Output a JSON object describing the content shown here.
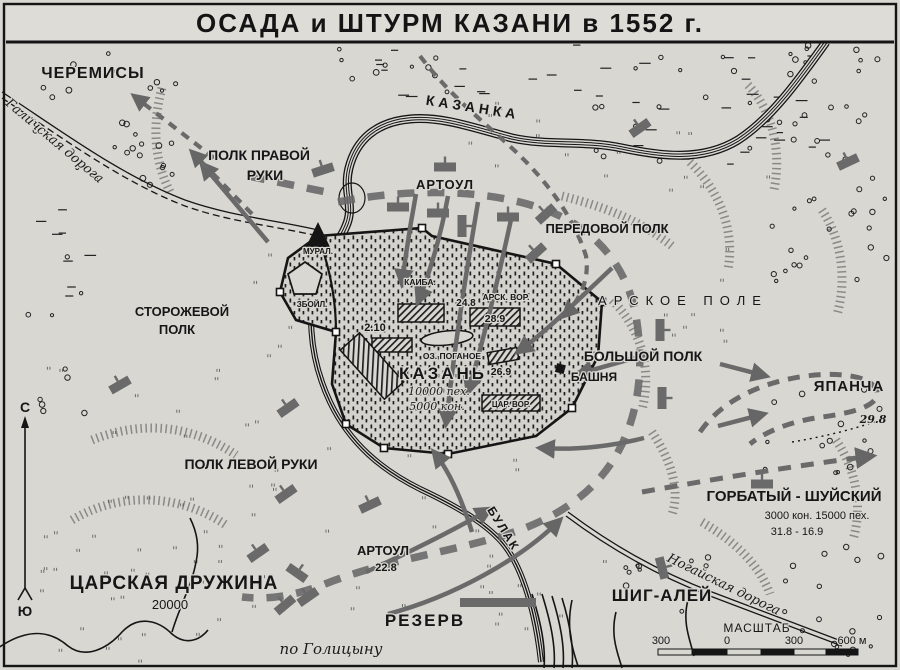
{
  "title": "ОСАДА  и  ШТУРМ  КАЗАНИ  в 1552 г.",
  "colors": {
    "paper": "#d8d7d2",
    "ink": "#151515",
    "military_gray": "#6a6a6a"
  },
  "compass": {
    "north": "С",
    "south": "Ю"
  },
  "rivers": {
    "kazanka": "КАЗАНКА",
    "bulak": "БУЛАК"
  },
  "roads": {
    "galich": "Галичская дорога",
    "nogai": "Ногайская дорога"
  },
  "places": {
    "cheremisy": "ЧЕРЕМИСЫ",
    "arskoe_pole": "АРСКОЕ ПОЛЕ",
    "yapancha": "ЯПАНЧА",
    "yapancha_date": "29.8",
    "bashnya": "БАШНЯ"
  },
  "city": {
    "name": "КАЗАНЬ",
    "garrison_infantry": "10000 пех.",
    "garrison_cavalry": "5000 кон.",
    "lake": "ОЗ. ПОГАНОЕ",
    "gates": {
      "kaiba": "КАИБА.",
      "mural": "МУРАЛ.",
      "zboyl": "ЗБОЙЛ.",
      "arsk": "АРСК. ВОР.",
      "tsar": "ЦАР. ВОР."
    },
    "dates": {
      "north": "24.8",
      "arsk": "28.9",
      "west": "2.10",
      "east": "26.9"
    }
  },
  "units": {
    "polk_pravoy_ruki": [
      "ПОЛК ПРАВОЙ",
      "РУКИ"
    ],
    "artoul_north": "АРТОУЛ",
    "peredovoy_polk": "ПЕРЕДОВОЙ ПОЛК",
    "storozhevoy_polk": [
      "СТОРОЖЕВОЙ",
      "ПОЛК"
    ],
    "bolshoy_polk": "БОЛЬШОЙ ПОЛК",
    "polk_levoy_ruki": "ПОЛК ЛЕВОЙ РУКИ",
    "gorbaty": {
      "name": "ГОРБАТЫЙ - ШУЙСКИЙ",
      "forces": "3000 кон. 15000 пех.",
      "dates": "31.8 - 16.9"
    },
    "tsarskaya": {
      "name": "ЦАРСКАЯ ДРУЖИНА",
      "forces": "20000"
    },
    "artoul_south": {
      "name": "АРТОУЛ",
      "date": "22.8"
    },
    "rezerv": "РЕЗЕРВ",
    "shig_aley": "ШИГ-АЛЕЙ"
  },
  "scale": {
    "title": "МАСШТАБ",
    "ticks": [
      "300",
      "0",
      "300",
      "600 м"
    ]
  },
  "credit": "по Голицыну"
}
